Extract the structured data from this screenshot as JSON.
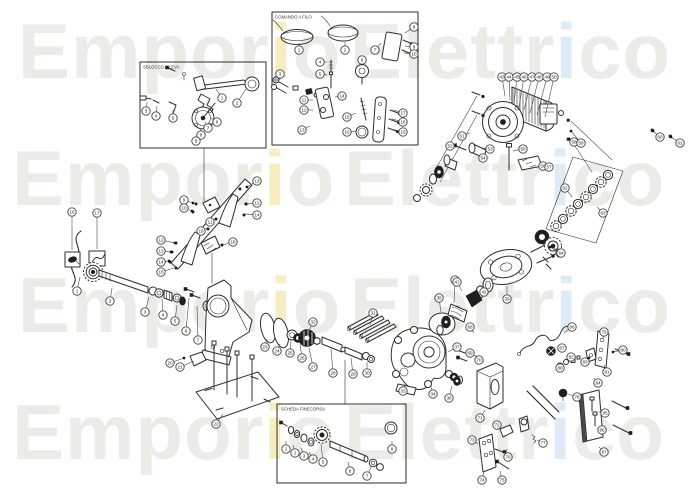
{
  "watermark": {
    "word_left": "Emporio",
    "word_right": "Elettrico",
    "base_color": "#edebe8",
    "accent_left_color": "#f6edc1",
    "accent_right_color": "#dcebf7",
    "rows": [
      {
        "lx": 18,
        "rx": 350,
        "y": 78
      },
      {
        "lx": 12,
        "rx": 344,
        "y": 205
      },
      {
        "lx": 18,
        "rx": 350,
        "y": 332
      },
      {
        "lx": 12,
        "rx": 344,
        "y": 459
      }
    ]
  },
  "insets": [
    {
      "label": "SBLOCCO A LEVA",
      "x": 140,
      "y": 62,
      "w": 126,
      "h": 86
    },
    {
      "label": "COMANDO A FILO",
      "x": 272,
      "y": 12,
      "w": 146,
      "h": 133
    },
    {
      "label": "SCHEDA FINECORSA",
      "x": 277,
      "y": 404,
      "w": 129,
      "h": 79
    }
  ],
  "callouts": [
    {
      "n": "1",
      "x": 77,
      "y": 291,
      "tx": 80,
      "ty": 277
    },
    {
      "n": "2",
      "x": 110,
      "y": 301,
      "tx": 112,
      "ty": 288
    },
    {
      "n": "3",
      "x": 145,
      "y": 312,
      "tx": 149,
      "ty": 297
    },
    {
      "n": "4",
      "x": 163,
      "y": 315,
      "tx": 162,
      "ty": 299
    },
    {
      "n": "5",
      "x": 175,
      "y": 321,
      "tx": 177,
      "ty": 305
    },
    {
      "n": "6",
      "x": 186,
      "y": 331,
      "tx": 189,
      "ty": 298
    },
    {
      "n": "7",
      "x": 198,
      "y": 340,
      "tx": 197,
      "ty": 306
    },
    {
      "n": "16",
      "x": 72,
      "y": 212,
      "tx": 72,
      "ty": 250
    },
    {
      "n": "17",
      "x": 97,
      "y": 213,
      "tx": 97,
      "ty": 249
    },
    {
      "n": "9",
      "x": 184,
      "y": 200,
      "tx": 193,
      "ty": 203,
      "dot": 1
    },
    {
      "n": "10",
      "x": 184,
      "y": 208,
      "tx": 192,
      "ty": 211,
      "dot": 1
    },
    {
      "n": "11",
      "x": 210,
      "y": 222,
      "tx": 215,
      "ty": 219
    },
    {
      "n": "12",
      "x": 161,
      "y": 240,
      "tx": 175,
      "ty": 243,
      "dot": 1
    },
    {
      "n": "13",
      "x": 161,
      "y": 251,
      "tx": 171,
      "ty": 252,
      "dot": 1
    },
    {
      "n": "14",
      "x": 161,
      "y": 262,
      "tx": 169,
      "ty": 261,
      "dot": 1
    },
    {
      "n": "15",
      "x": 161,
      "y": 272,
      "tx": 174,
      "ty": 268
    },
    {
      "n": "13",
      "x": 257,
      "y": 181,
      "tx": 247,
      "ty": 187,
      "dot": 1
    },
    {
      "n": "12",
      "x": 257,
      "y": 203,
      "tx": 246,
      "ty": 204,
      "dot": 1
    },
    {
      "n": "14",
      "x": 257,
      "y": 215,
      "tx": 245,
      "ty": 214
    },
    {
      "n": "18",
      "x": 233,
      "y": 242,
      "tx": 223,
      "ty": 245
    },
    {
      "n": "19",
      "x": 201,
      "y": 231,
      "tx": 207,
      "ty": 228
    },
    {
      "n": "20",
      "x": 170,
      "y": 363,
      "tx": 184,
      "ty": 358,
      "dot": 1
    },
    {
      "n": "21",
      "x": 180,
      "y": 367,
      "tx": 194,
      "ty": 361
    },
    {
      "n": "22",
      "x": 216,
      "y": 424,
      "tx": 223,
      "ty": 414
    },
    {
      "n": "23",
      "x": 265,
      "y": 347,
      "tx": 267,
      "ty": 339
    },
    {
      "n": "24",
      "x": 277,
      "y": 351,
      "tx": 280,
      "ty": 344
    },
    {
      "n": "25",
      "x": 290,
      "y": 353,
      "tx": 291,
      "ty": 341
    },
    {
      "n": "26",
      "x": 302,
      "y": 358,
      "tx": 300,
      "ty": 344
    },
    {
      "n": "27",
      "x": 313,
      "y": 367,
      "tx": 309,
      "ty": 348
    },
    {
      "n": "28",
      "x": 333,
      "y": 373,
      "tx": 331,
      "ty": 349
    },
    {
      "n": "29",
      "x": 353,
      "y": 374,
      "tx": 351,
      "ty": 358
    },
    {
      "n": "30",
      "x": 367,
      "y": 373,
      "tx": 367,
      "ty": 362
    },
    {
      "n": "31",
      "x": 373,
      "y": 313,
      "tx": 370,
      "ty": 325
    },
    {
      "n": "32",
      "x": 313,
      "y": 322,
      "tx": 309,
      "ty": 331
    },
    {
      "n": "33",
      "x": 403,
      "y": 391,
      "tx": 405,
      "ty": 384
    },
    {
      "n": "34",
      "x": 433,
      "y": 394,
      "tx": 431,
      "ty": 387
    },
    {
      "n": "35",
      "x": 439,
      "y": 298,
      "tx": 441,
      "ty": 312
    },
    {
      "n": "36",
      "x": 455,
      "y": 280,
      "tx": 454,
      "ty": 303
    },
    {
      "n": "37",
      "x": 457,
      "y": 347,
      "tx": 448,
      "ty": 352
    },
    {
      "n": "38",
      "x": 449,
      "y": 398,
      "tx": 452,
      "ty": 386
    },
    {
      "n": "39",
      "x": 507,
      "y": 299,
      "tx": 507,
      "ty": 286
    },
    {
      "n": "40",
      "x": 560,
      "y": 253,
      "tx": 550,
      "ty": 247,
      "dot": 1
    },
    {
      "n": "41",
      "x": 457,
      "y": 282,
      "tx": 462,
      "ty": 291
    },
    {
      "n": "42",
      "x": 484,
      "y": 292,
      "tx": 486,
      "ty": 287
    },
    {
      "n": "43",
      "x": 502,
      "y": 77,
      "tx": 505,
      "ty": 96
    },
    {
      "n": "44",
      "x": 509,
      "y": 77,
      "tx": 510,
      "ty": 100
    },
    {
      "n": "45",
      "x": 517,
      "y": 77,
      "tx": 514,
      "ty": 104
    },
    {
      "n": "46",
      "x": 524,
      "y": 77,
      "tx": 519,
      "ty": 107
    },
    {
      "n": "47",
      "x": 532,
      "y": 77,
      "tx": 524,
      "ty": 110
    },
    {
      "n": "48",
      "x": 539,
      "y": 77,
      "tx": 530,
      "ty": 113
    },
    {
      "n": "49",
      "x": 547,
      "y": 77,
      "tx": 537,
      "ty": 115
    },
    {
      "n": "50",
      "x": 554,
      "y": 77,
      "tx": 545,
      "ty": 117
    },
    {
      "n": "51",
      "x": 462,
      "y": 136,
      "tx": 470,
      "ty": 133
    },
    {
      "n": "52",
      "x": 450,
      "y": 146,
      "tx": 457,
      "ty": 143
    },
    {
      "n": "53",
      "x": 490,
      "y": 149,
      "tx": 483,
      "ty": 148
    },
    {
      "n": "54",
      "x": 483,
      "y": 158,
      "tx": 478,
      "ty": 155
    },
    {
      "n": "55",
      "x": 523,
      "y": 149,
      "tx": 513,
      "ty": 151
    },
    {
      "n": "56",
      "x": 543,
      "y": 166,
      "tx": 541,
      "ty": 163
    },
    {
      "n": "57",
      "x": 549,
      "y": 167
    },
    {
      "n": "58",
      "x": 574,
      "y": 142,
      "tx": 569,
      "ty": 139,
      "dot": 1
    },
    {
      "n": "59",
      "x": 581,
      "y": 143,
      "tx": 571,
      "ty": 131,
      "dot": 1
    },
    {
      "n": "60",
      "x": 660,
      "y": 137,
      "tx": 653,
      "ty": 131,
      "dot": 1
    },
    {
      "n": "61",
      "x": 680,
      "y": 143,
      "tx": 671,
      "ty": 137,
      "dot": 1
    },
    {
      "n": "62",
      "x": 565,
      "y": 188,
      "tx": 572,
      "ty": 197
    },
    {
      "n": "63",
      "x": 603,
      "y": 213,
      "tx": 597,
      "ty": 207
    },
    {
      "n": "64",
      "x": 561,
      "y": 253,
      "tx": 554,
      "ty": 248
    },
    {
      "n": "66",
      "x": 572,
      "y": 327,
      "tx": 564,
      "ty": 333
    },
    {
      "n": "67",
      "x": 562,
      "y": 348,
      "tx": 557,
      "ty": 350
    },
    {
      "n": "68",
      "x": 470,
      "y": 327,
      "tx": 474,
      "ty": 333
    },
    {
      "n": "69",
      "x": 470,
      "y": 353,
      "tx": 477,
      "ty": 357,
      "dot": 1
    },
    {
      "n": "70",
      "x": 479,
      "y": 360,
      "tx": 484,
      "ty": 362
    },
    {
      "n": "71",
      "x": 480,
      "y": 418,
      "tx": 485,
      "ty": 410
    },
    {
      "n": "72",
      "x": 497,
      "y": 425,
      "tx": 501,
      "ty": 429
    },
    {
      "n": "73",
      "x": 472,
      "y": 440,
      "tx": 478,
      "ty": 444
    },
    {
      "n": "74",
      "x": 482,
      "y": 480,
      "tx": 484,
      "ty": 471
    },
    {
      "n": "75",
      "x": 502,
      "y": 480,
      "tx": 500,
      "ty": 471
    },
    {
      "n": "76",
      "x": 508,
      "y": 457,
      "tx": 506,
      "ty": 449
    },
    {
      "n": "77",
      "x": 543,
      "y": 443,
      "tx": 537,
      "ty": 440
    },
    {
      "n": "78",
      "x": 577,
      "y": 397,
      "tx": 568,
      "ty": 394
    },
    {
      "n": "79",
      "x": 604,
      "y": 332,
      "tx": 603,
      "ty": 339
    },
    {
      "n": "80",
      "x": 623,
      "y": 350,
      "tx": 613,
      "ty": 352,
      "dot": 1
    },
    {
      "n": "81",
      "x": 607,
      "y": 372,
      "tx": 604,
      "ty": 365
    },
    {
      "n": "82",
      "x": 571,
      "y": 357,
      "tx": 576,
      "ty": 358
    },
    {
      "n": "83",
      "x": 585,
      "y": 362,
      "tx": 589,
      "ty": 358,
      "dot": 1
    },
    {
      "n": "84",
      "x": 598,
      "y": 383,
      "tx": 594,
      "ty": 378
    },
    {
      "n": "85",
      "x": 605,
      "y": 413,
      "tx": 599,
      "ty": 412
    },
    {
      "n": "86",
      "x": 602,
      "y": 430,
      "tx": 597,
      "ty": 428
    },
    {
      "n": "87",
      "x": 604,
      "y": 452,
      "tx": 599,
      "ty": 447
    },
    {
      "n": "88",
      "x": 560,
      "y": 368,
      "tx": 564,
      "ty": 365
    },
    {
      "n": "1",
      "x": 222,
      "y": 98,
      "tx": 216,
      "ty": 89
    },
    {
      "n": "2",
      "x": 237,
      "y": 103,
      "tx": 246,
      "ty": 89
    },
    {
      "n": "3",
      "x": 146,
      "y": 111,
      "tx": 147,
      "ty": 102
    },
    {
      "n": "4",
      "x": 156,
      "y": 116,
      "tx": 157,
      "ty": 106
    },
    {
      "n": "5",
      "x": 173,
      "y": 118,
      "tx": 173,
      "ty": 110
    },
    {
      "n": "6",
      "x": 217,
      "y": 122,
      "tx": 211,
      "ty": 118
    },
    {
      "n": "7",
      "x": 208,
      "y": 128,
      "tx": 205,
      "ty": 122
    },
    {
      "n": "8",
      "x": 201,
      "y": 135,
      "tx": 200,
      "ty": 128
    },
    {
      "n": "9",
      "x": 196,
      "y": 141,
      "tx": 197,
      "ty": 133
    },
    {
      "n": "1",
      "x": 299,
      "y": 50,
      "tx": 299,
      "ty": 43
    },
    {
      "n": "2",
      "x": 345,
      "y": 50,
      "tx": 345,
      "ty": 42
    },
    {
      "n": "3",
      "x": 280,
      "y": 74,
      "tx": 280,
      "ty": 80
    },
    {
      "n": "4",
      "x": 320,
      "y": 62,
      "tx": 327,
      "ty": 62
    },
    {
      "n": "5",
      "x": 320,
      "y": 74,
      "tx": 327,
      "ty": 75
    },
    {
      "n": "6",
      "x": 362,
      "y": 60,
      "tx": 362,
      "ty": 66
    },
    {
      "n": "7",
      "x": 375,
      "y": 50,
      "tx": 381,
      "ty": 43
    },
    {
      "n": "8",
      "x": 414,
      "y": 27,
      "tx": 405,
      "ty": 33
    },
    {
      "n": "9",
      "x": 414,
      "y": 47,
      "tx": 405,
      "ty": 46
    },
    {
      "n": "10",
      "x": 414,
      "y": 54,
      "tx": 404,
      "ty": 53
    },
    {
      "n": "11",
      "x": 304,
      "y": 100,
      "tx": 313,
      "ty": 100
    },
    {
      "n": "12",
      "x": 304,
      "y": 110,
      "tx": 313,
      "ty": 110
    },
    {
      "n": "13",
      "x": 302,
      "y": 130,
      "tx": 310,
      "ty": 126
    },
    {
      "n": "14",
      "x": 342,
      "y": 96,
      "tx": 335,
      "ty": 97
    },
    {
      "n": "15",
      "x": 347,
      "y": 117,
      "tx": 356,
      "ty": 113
    },
    {
      "n": "16",
      "x": 347,
      "y": 132,
      "tx": 356,
      "ty": 131
    },
    {
      "n": "17",
      "x": 403,
      "y": 113,
      "tx": 393,
      "ty": 110
    },
    {
      "n": "18",
      "x": 403,
      "y": 122,
      "tx": 392,
      "ty": 119
    },
    {
      "n": "19",
      "x": 403,
      "y": 132,
      "tx": 391,
      "ty": 129
    },
    {
      "n": "1",
      "x": 286,
      "y": 449,
      "tx": 286,
      "ty": 441
    },
    {
      "n": "2",
      "x": 295,
      "y": 453,
      "tx": 293,
      "ty": 445
    },
    {
      "n": "3",
      "x": 304,
      "y": 456,
      "tx": 301,
      "ty": 448
    },
    {
      "n": "4",
      "x": 313,
      "y": 459,
      "tx": 309,
      "ty": 452
    },
    {
      "n": "5",
      "x": 323,
      "y": 462,
      "tx": 321,
      "ty": 444
    },
    {
      "n": "6",
      "x": 350,
      "y": 471,
      "tx": 348,
      "ty": 462
    },
    {
      "n": "7",
      "x": 367,
      "y": 476,
      "tx": 371,
      "ty": 467
    },
    {
      "n": "8",
      "x": 392,
      "y": 449,
      "tx": 392,
      "ty": 441
    }
  ]
}
